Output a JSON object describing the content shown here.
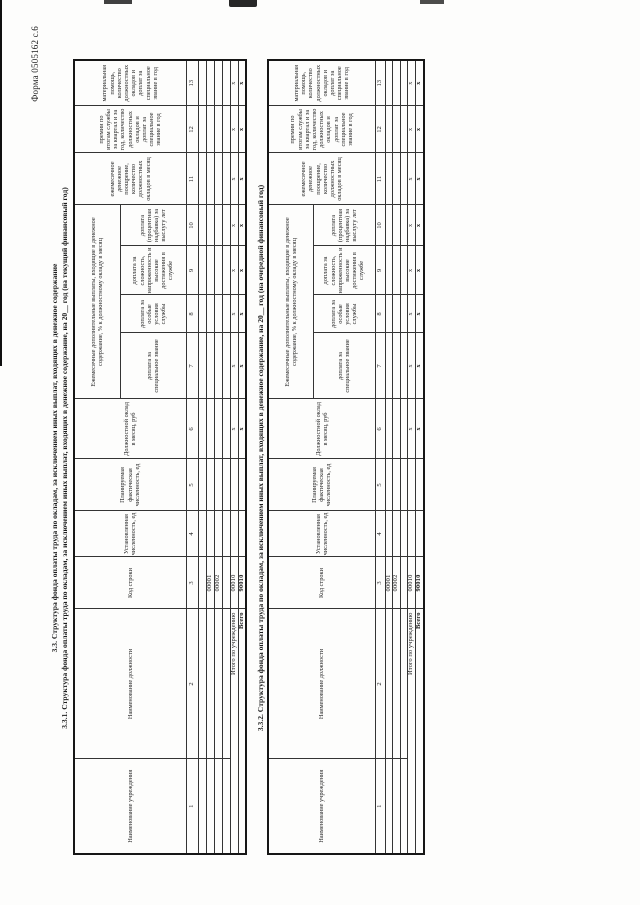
{
  "form_ref": "Форма 0505162 с.6",
  "section_heading": "3.3. Структура фонда оплаты труда по окладам, за исключением иных выплат, входящих в денежное содержание",
  "group_header": "Ежемесячные дополнительные выплаты, входящие в денежное содержание, % к должностному окладу в месяц",
  "totals_x_mark": "х",
  "columns": [
    {
      "num": "1",
      "label": "Наименование учреждения",
      "width": 95,
      "group": false
    },
    {
      "num": "2",
      "label": "Наименование должности",
      "width": 150,
      "group": false
    },
    {
      "num": "3",
      "label": "Код строки",
      "width": 52,
      "group": false
    },
    {
      "num": "4",
      "label": "Установленная численность, ед",
      "width": 46,
      "group": false
    },
    {
      "num": "5",
      "label": "Планируемая фактическая численность, ед",
      "width": 52,
      "group": false
    },
    {
      "num": "6",
      "label": "Должностной оклад в месяц, руб",
      "width": 60,
      "group": false
    },
    {
      "num": "7",
      "label": "доплата за специальное звание",
      "width": 66,
      "group": true
    },
    {
      "num": "8",
      "label": "доплата за особые условия службы",
      "width": 38,
      "group": true
    },
    {
      "num": "9",
      "label": "доплата за сложность, напряженность и высокие достижения в службе",
      "width": 49,
      "group": true
    },
    {
      "num": "10",
      "label": "доплата (процентная надбавка) за выслугу лет",
      "width": 41,
      "group": true
    },
    {
      "num": "11",
      "label": "ежемесячное денежное поощрение, количество должностных окладов в месяц",
      "width": 52,
      "group": false
    },
    {
      "num": "12",
      "label": "премии по итогам службы за квартал и за год, количество должностных окладов и доплат за специальное звание в год",
      "width": 47,
      "group": false
    },
    {
      "num": "13",
      "label": "материальная помощь, количество должностных окладов и доплат за специальное звание в год",
      "width": 46,
      "group": false
    }
  ],
  "tables": [
    {
      "title": "3.3.1. Структура фонда оплаты труда по окладам, за исключением иных выплат, входящих в денежное содержание, на 20__ год (на текущий финансовый год)",
      "rows": [
        {
          "type": "empty"
        },
        {
          "type": "code",
          "code": "00001"
        },
        {
          "type": "code",
          "code": "00002"
        },
        {
          "type": "empty"
        },
        {
          "type": "total",
          "label": "Итого по учреждению",
          "code": "00010",
          "bold": false
        },
        {
          "type": "total",
          "label": "Всего",
          "code": "90010",
          "bold": true
        }
      ]
    },
    {
      "title": "3.3.2. Структура фонда оплаты труда по окладам, за исключением иных выплат, входящих в денежное содержание, на 20__ год (на очередной финансовый год)",
      "rows": [
        {
          "type": "code",
          "code": "00001"
        },
        {
          "type": "code",
          "code": "00002"
        },
        {
          "type": "empty"
        },
        {
          "type": "total",
          "label": "Итого по учреждению",
          "code": "00010",
          "bold": false
        },
        {
          "type": "total",
          "label": "Всего",
          "code": "90010",
          "bold": true
        }
      ]
    }
  ]
}
